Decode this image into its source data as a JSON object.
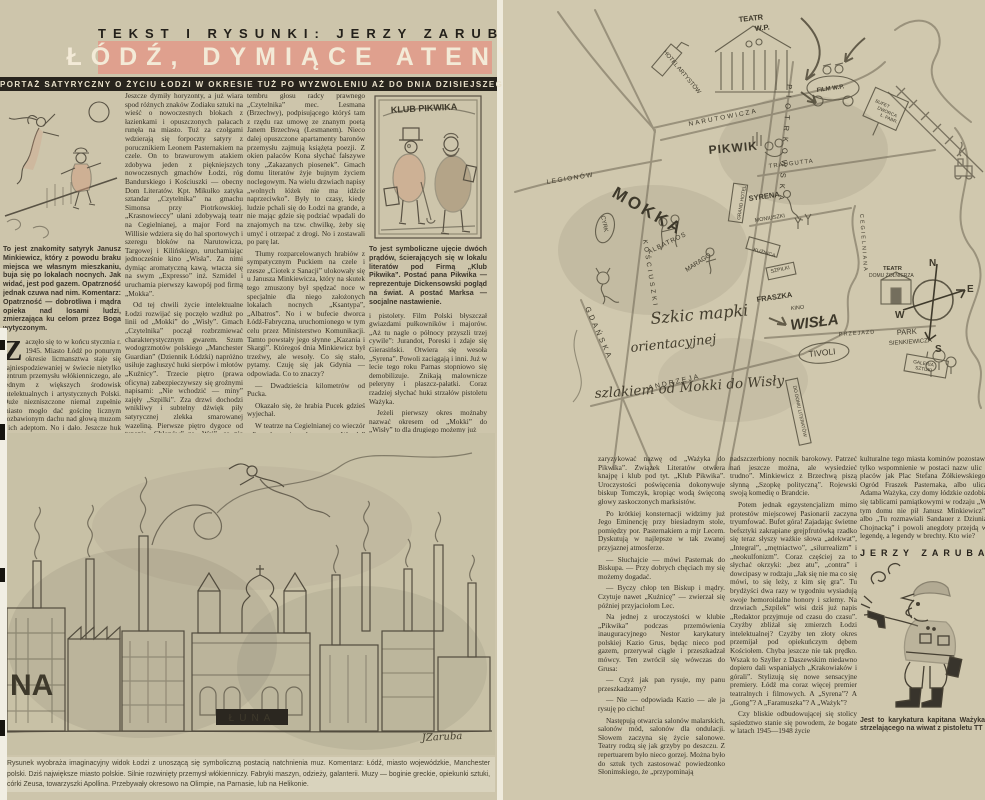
{
  "header": {
    "kicker": "TEKST I RYSUNKI: JERZY ZARUBA",
    "title": "ŁÓDŹ, DYMIĄCE ATENY",
    "subtitle": "( REPORTAŻ SATYRYCZNY O ŻYCIU ŁODZI W OKRESIE TUŻ PO WYZWOLENIU AŻ DO DNIA DZISIEJSZEGO )"
  },
  "left_page": {
    "figure1_caption": "To jest znakomity satyryk Janusz Minkiewicz, który z powodu braku miejsca we własnym mieszkaniu, buja się po lokalach nocnych. Jak widać, jest pod gazem. Opatrzność jednak czuwa nad nim. Komentarz: Opatrzność — dobrotliwa i mądra opieka nad losami ludzi, zmierzająca ku celom przez Boga wytyczonym.",
    "intro_dropcap": "Z",
    "intro": "aczęło się to w końcu stycznia r. 1945. Miasto Łódź po ponurym okresie licmansztwa staje się najniespodziewaniej w świecie nietylko centrum przemysłu włókienniczego, ale jednym z większych środowisk intelektualnych i artystycznych Polski. Duże niezniszczone niemal zupełnie miasto mogło dać gościnę licznym pozbawionym dachu nad głową muzom i ich adeptom. No i dało. Jeszcze huk armatni grał w uszach...",
    "col2": [
      "Jeszcze dymiły horyzonty, a już wiara spod różnych znaków Zodiaku sztuki na wieść o nowoczesnych blokach z łazienkami i opuszczonych pałacach runęła na miasto. Tuż za czołgami wdzierają się forpoczty satyry z porucznikiem Leonem Pasternakiem na czele. On to brawurowym atakiem zdobywa jeden z piękniejszych nowoczesnych gmachów Łodzi, róg Bandurskiego i Kościuszki — obecny Dom Literatów. Kpt. Mikułko zatyka sztandar „Czytelnika” na gmachu Simonsa przy Piotrkowskiej. „Krasnowieccy” ułani zdobywają teatr na Cegielnianej, a major Ford na Willisie wdziera się do hal sportowych i szeregu bloków na Narutowicza, Targowej i Kilińskiego, uruchamiając jednocześnie kino „Wisła”. Za nimi dymiąc aromatyczną kawą, wtacza się na swym „Expresso” inż. Szmidel i uruchamia pierwszy kawopój pod firmą „Mokka”.",
      "Od tej chwili życie intelektualne Łodzi rozwijać się poczęło wzdłuż po linii od „Mokki” do „Wisły”. Gmach „Czytelnika” począł rozbrzmiewać charakterystycznym gwarem. Szum wodogrzmotów polskiego „Manchester Guardian” (Dziennik Łódzki) napróżno usiłuje zagłuszyć huki sierpów i młotów „Kuźnicy”. Trzecie piętro (prawa oficyna) zabezpieczywszy się groźnymi napisami: „Nie wchodzić — miny” zajęły „Szpilki”. Zza drzwi dochodzi wnikliwy i subtelny dźwięk piły satyrycznej zlekka smarowanej wazeliną. Pierwsze piętro dygoce od tupania „Chłopów” ze „Wsi”, co nie przeszkadza jednak słyszeć uwodzicielskiego"
    ],
    "col3": [
      "tembru głosu radcy prawnego „Czytelnika” mec. Lesmana (Brzechwy), podpisującego któryś tam z rzędu raz umowę ze znanym poetą Janem Brzechwą (Lesmanem). Nieco dalej opuszczone apartamenty baronów przemysłu zajmują książęta poezji. Z okien pałaców Kona słychać fałszywe tony „Zakazanych piosenek”. Gmach domu literatów żyje bujnym życiem noclegowym. Na wielu drzwiach napisy „wolnych łóżek nie ma idźcie naprzeciwko”. Były to czasy, kiedy ludzie pchali się do Łodzi na grande, a nie mając gdzie się podziać wpadali do znajomych na tzw. chwilkę, żeby się umyć i otrzepać z drogi. No i zostawali po parę lat.",
      "Tłumy rozparcelowanych hrabiów z sympatycznym Puckiem na czele i rzesze „Ciotek z Sanacji” ulokowały się u Janusza Minkiewicza, który na skutek tego zmuszony był spędzać noce w specjalnie dla niego założonych lokalach nocnych „Ksantypa”, „Albatros”. No i w bufecie dworca Łódź-Fabryczna, uruchomionego w tym celu przez Ministerstwo Komunikacji. Tamto powstały jego słynne „Kazania i Skargi”. Któregoś dnia Minkiewicz był trzeźwy, ale wesoły. Co się stało, pytamy. Czuję się jak Gdynia — odpowiada. Co to znaczy?",
      "— Dwadzieścia kilometrów od Pucka.",
      "Okazało się, że hrabia Pucek gdzieś wyjechał.",
      "W teatrze na Cegielnianej co wieczór odbywało się huczne „Wesele” Wyspiańskiego i „wszystkim się zdawało, że to gra tak, a to wojsko grało”. Łódź artystyczna nosiła jeszcze wtedy mundury"
    ],
    "figure2": {
      "sign": "KLUB PIKWIKA",
      "caption": "To jest symboliczne ujęcie dwóch prądów, ścierających się w lokalu literatów pod Firmą „Klub Pikwika”. Postać pana Pikwika — reprezentuje Dickensowski pogląd na świat. A postać Marksa — socjalne nastawienie."
    },
    "col4": [
      "i pistolety. Film Polski błyszczał gwiazdami pułkowników i majorów. „Aż tu nagle o północy przyszli trzej cywile”: Jurandot, Poreski i zdaje się Gierasiński. Otwiera się wesoła „Syrena”. Powoli zaciągają i inni. Już w lecie tego roku Parnas stopniowo się demobilizuje. Znikają malownicze peleryny i płaszcz-pałatki. Coraz rzadziej słychać huki strzałów pistoletu Ważyka.",
      "Jeżeli pierwszy okres możnaby nazwać okresem od „Mokki” do „Wisły” to dla drugiego możemy już"
    ],
    "drawing": {
      "letters": "NA",
      "marquee": "ŁUNA",
      "signature": "JZaruba"
    },
    "bottom_caption": "Rysunek wyobraża imaginacyjny widok Łodzi z unoszącą się symboliczną postacią natchnienia muz. Komentarz: Łódź, miasto wojewódzkie, Manchester polski. Dziś największe miasto polskie. Silnie rozwinięty przemysł włókienniczy. Fabryki maszyn, odzieży, galanterii. Muzy — boginie greckie, opiekunki sztuki, córki Zeusa, towarzyszki Apollina. Przebywały okresowo na Olimpie, na Parnasie, lub na Helikonie."
  },
  "right_page": {
    "map": {
      "labels": {
        "mokka": "MOKKA",
        "hotel_artystow": "HOTEL ARTYSTÓW",
        "teatr_wp_1": "TEATR",
        "teatr_wp_2": "W.P.",
        "film_wp": "FILM W.P.",
        "bufet_1": "BUFET",
        "bufet_2": "DWORCA",
        "bufet_3": "Ł. FABR.",
        "pikwik": "PIKWIK",
        "cyrk": "CYRK",
        "albatros": "ALBATROS",
        "marago": "MARAGO",
        "grand_hotel": "GRAND HOTEL",
        "syrena": "SYRENA",
        "kuznica": "KUŹNICA",
        "szpilki": "SZPILKI",
        "fraszka": "FRASZKA",
        "kino": "KINO",
        "wisla": "WISŁA",
        "tivoli": "TIVOLI",
        "park_1": "PARK",
        "park_2": "SIENKIEWICZA",
        "galeria_1": "GALERIA",
        "galeria_2": "SZTUKI",
        "teatr_domu_1": "TEATR",
        "teatr_domu_2": "DOMU ŻOŁNIERZA",
        "do_domu": "DO DOMU LITERATÓW",
        "narutowicza": "NARUTOWICZA",
        "traugutta": "TRAUGUTTA",
        "legionow": "LEGIONÓW",
        "kosciuszki": "KOŚCIUSZKI",
        "piotrkowska": "PIOTRKOWSKA",
        "moniuszki": "MONIUSZKI",
        "cegielniana": "CEGIELNIANA",
        "andrzeja": "ANDRZEJA",
        "gdanska": "GDAŃSKA",
        "przejazd": "PRZEJAZD"
      },
      "compass": {
        "n": "N",
        "e": "E",
        "s": "S",
        "w": "W"
      },
      "caption_lines": [
        "Szkic mapki",
        "orientacyjnej",
        "szlakiem od Mokki do Wisły"
      ]
    },
    "col1": [
      "zaryzykować nazwę od „Ważyka do Pikwika”. Związek Literatów otwiera knajpę i klub pod tyt. „Klub Pikwika”. Uroczystości poświęcenia dokonywuje biskup Tomczyk, kropiąc wodą święconą głowy zaskoczonych marksistów.",
      "Po krótkiej konsternacji widzimy już Jego Eminencję przy biesiadnym stole, pomiędzy por. Pasternakiem a mjr Lecem. Dyskutują w najlepsze w tak zwanej przyjaznej atmosferze.",
      "— Słuchajcie — mówi Pasternak do Biskupa. — Przy dobrych chęciach my się możemy dogadać.",
      "— Byczy chłop ten Biskup i mądry. Czytuje nawet „Kuźnicę” — zwierzał się później przyjaciołom Lec.",
      "Na jednej z uroczystości w klubie „Pikwika” podczas przemówienia inauguracyjnego Nestor karykatury polskiej Kazio Grus, będąc nieco pod gazem, przerywał ciągle i przeszkadzał mówcy. Ten zwrócił się wówczas do Grusa:",
      "— Czyż jak pan rysuje, my panu przeszkadzamy?",
      "— Nie — odpowiada Kazio — ale ja rysuję po cichu!",
      "Następują otwarcia salonów malarskich, salonów mód, salonów dla ondulacji. Słowem zaczyna się życie salonowe. Teatry rodzą się jak grzyby po deszczu. Z repertuarem było nieco gorzej. Można było do sztuk tych zastosować powiedzonko Słonimskiego, że „przypominają"
    ],
    "col2": [
      "nadszczerbiony nocnik barokowy. Patrzeć nań jeszcze można, ale wysiedzieć trudno”. Minkiewicz z Brzechwą piszą słynną „Szopkę polityczną”. Rojewski swoją komedię o Brandcie.",
      "Potem jednak egzystencjalizm mimo protestów miejscowej Pasionarii zaczyna tryumfować. Bufet góra! Zajadając świetne befsztyki zakrapiane grejpfrutówką rzadko się teraz słyszy ważkie słowa „adekwat”, „Integral”, „mętniactwo”, „silurrealizm” i „neokulfonizm”. Coraz częściej za to słychać okrzyki: „bez atu”, „contra” i dowcipasy w rodzaju „Jak się nie ma co się mówi, to się leży, z kim się gra”. Tu brydżyści dwa razy w tygodniu wysiadują swoje hemoroidalne honory i szlemy. Na drzwiach „Szpilek” wisi dziś już napis „Redaktor przyjmuje od czasu do czasu”. Czyżby zbliżał się zmierzch Łodzi intelektualnej? Czyżby ten złoty okres przemijał pod opiekuńczym dębem Kościołem. Chyba jeszcze nie tak prędko. Wszak to Szyller z Daszewskim niedawno dopiero dali wspaniałych „Krakowiaków i górali”. Stylizują się nowe sensacyjne premiery. Łódź ma coraz więcej premier teatralnych i filmowych. A „Syrena”? A „Gong”? A „Faramuszka”? A „Ważyk”?",
      "Czy bliskie odbudowującej się stolicy sąsiedztwo stanie się powodem, że bogate w latach 1945—1948 życie"
    ],
    "col3": [
      "kulturalne tego miasta kominów pozostawi tylko wspomnienie w postaci nazw ulic i placów jak Plac Stefana Żółkiewskiego, Ogród Fraszek Pasternaka, albo ulica Adama Ważyka, czy domy łódzkie ozdobią się tablicami pamiątkowymi w rodzaju „W tym domu nie pił Janusz Minkiewicz”, albo „Tu rozmawiali Sandauer z Dziunią Chojnacką” i powoli anegdoty przejdą w legendę, a legendy w brechty. Kto wie?"
    ],
    "byline": "JERZY ZARUBA",
    "caricature_caption": "Jest to karykatura kapitana Ważyka, strzelającego na wiwat z pistoletu TT"
  }
}
